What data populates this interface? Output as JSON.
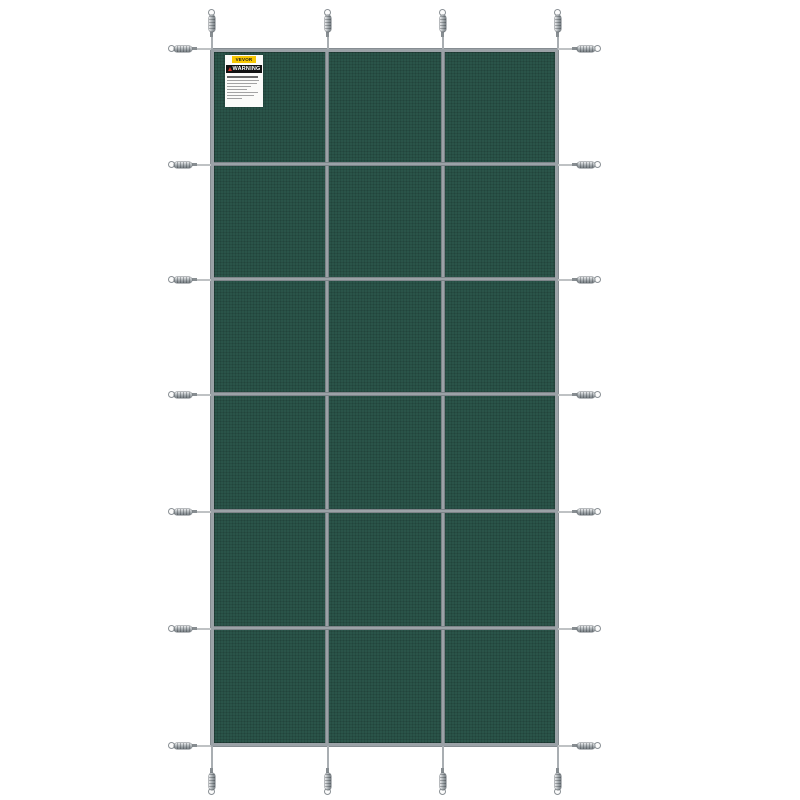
{
  "figure": {
    "type": "product-photo",
    "subject": "Green rectangular mesh safety pool cover with gray strap grid and metal spring anchors on a white background",
    "background_color": "#ffffff"
  },
  "cover": {
    "fabric_color": "#2a5449",
    "strap_color": "#9ba2a7",
    "grid_columns": 3,
    "grid_rows": 6,
    "anchor_counts": {
      "top": 4,
      "bottom": 4,
      "left": 7,
      "right": 7
    }
  },
  "warning_label": {
    "brand": "VEVOR",
    "title": "WARNING",
    "brand_bg_color": "#f7c700",
    "title_bg_color": "#111111"
  }
}
